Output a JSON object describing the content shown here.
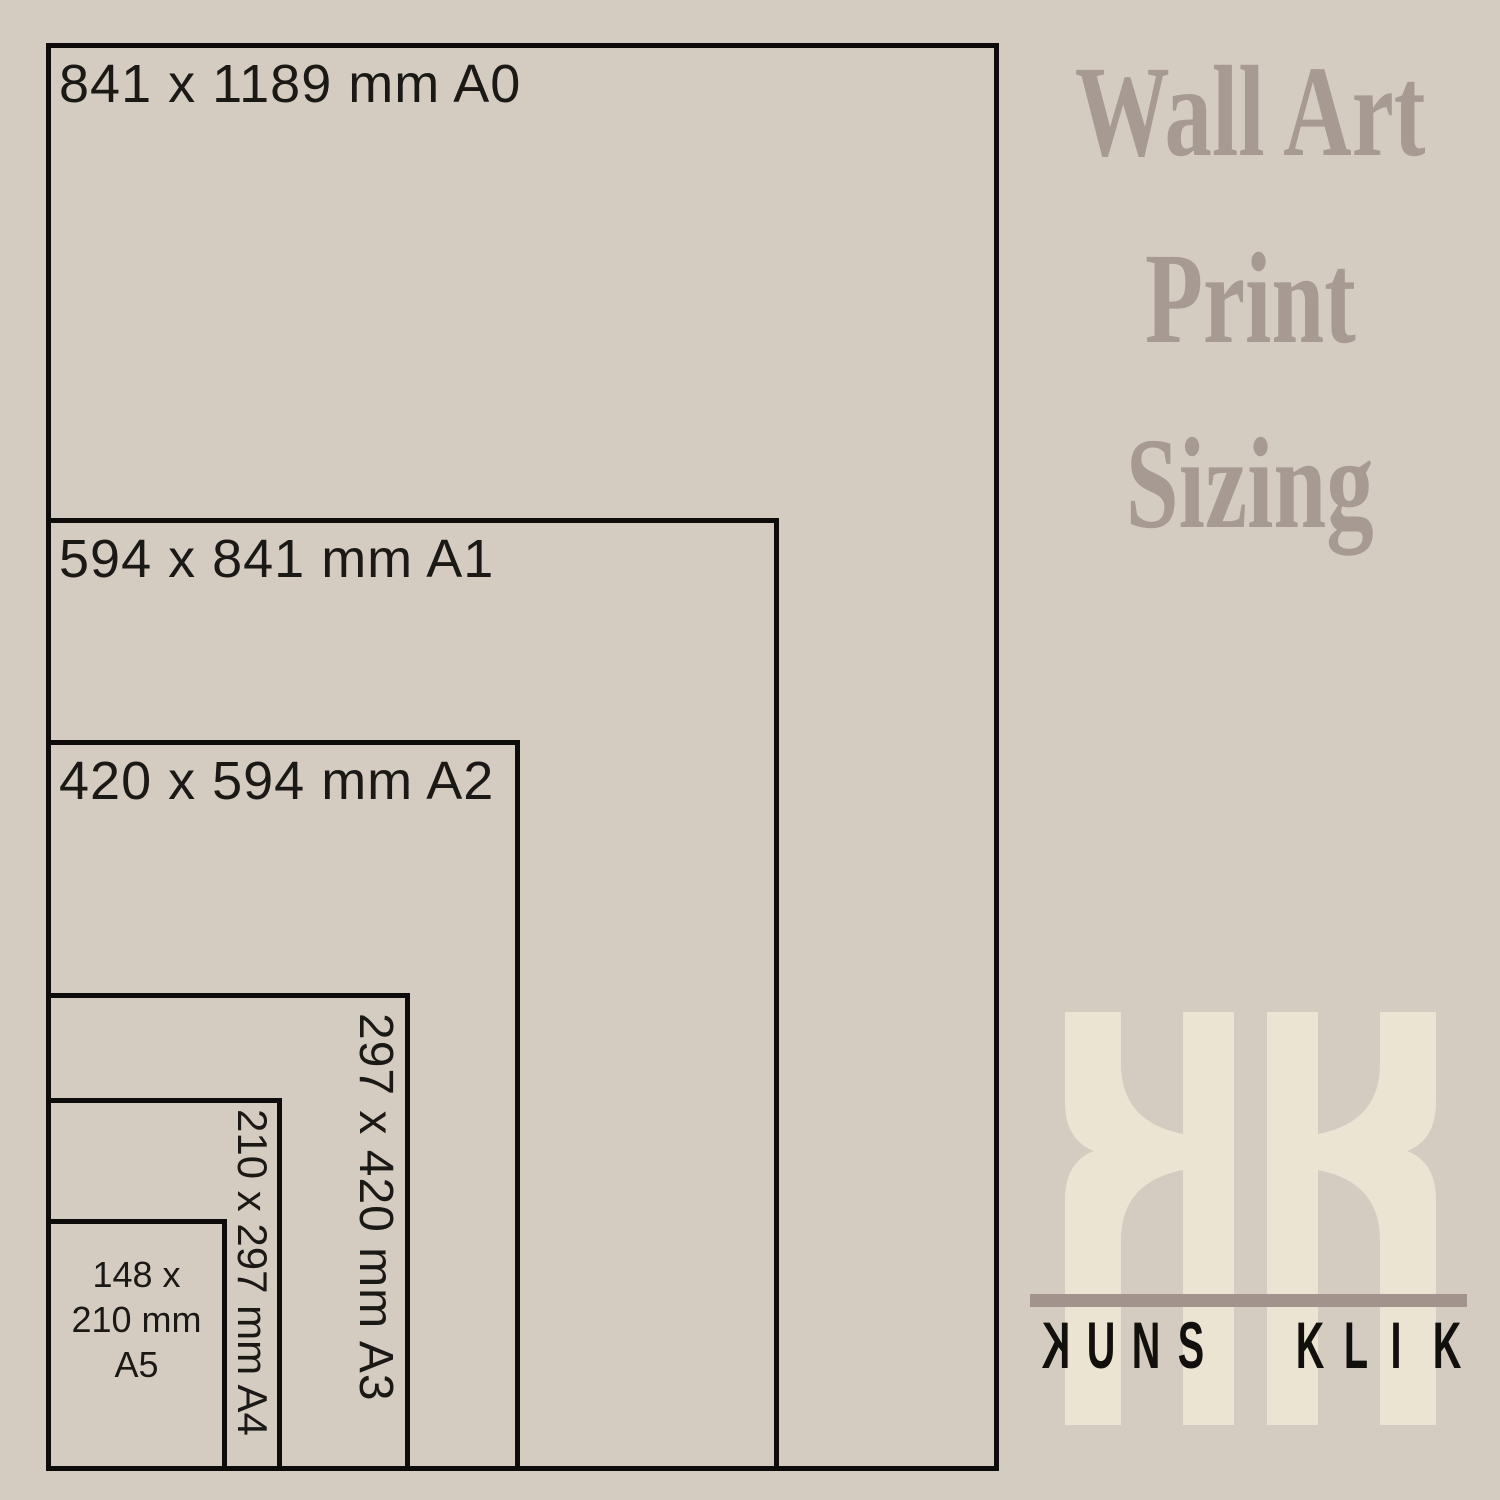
{
  "page": {
    "background_color": "#d5ccc1",
    "line_color": "#0d0c0a",
    "label_color": "#1b1916"
  },
  "title": {
    "lines": [
      "Wall Art",
      "Print",
      "Sizing"
    ],
    "color": "#a79a93"
  },
  "size_boxes": [
    {
      "code": "A0",
      "label": "841 x 1189 mm A0",
      "label_orientation": "horizontal"
    },
    {
      "code": "A1",
      "label": "594 x 841 mm A1",
      "label_orientation": "horizontal"
    },
    {
      "code": "A2",
      "label": "420 x 594 mm A2",
      "label_orientation": "horizontal"
    },
    {
      "code": "A3",
      "label": "297 x 420 mm A3",
      "label_orientation": "vertical"
    },
    {
      "code": "A4",
      "label": "210 x 297 mm A4",
      "label_orientation": "vertical"
    },
    {
      "code": "A5",
      "label_lines": [
        "148 x",
        "210 mm",
        "A5"
      ],
      "label_orientation": "horizontal-stacked"
    }
  ],
  "logo": {
    "monogram": "KK",
    "monogram_color": "#ece4d3",
    "divider_color": "#a3938d",
    "wordmark": "KUNS KLIK",
    "wordmark_color": "#12100d",
    "letters": [
      "K",
      "U",
      "N",
      "S",
      "K",
      "L",
      "I",
      "K"
    ]
  }
}
